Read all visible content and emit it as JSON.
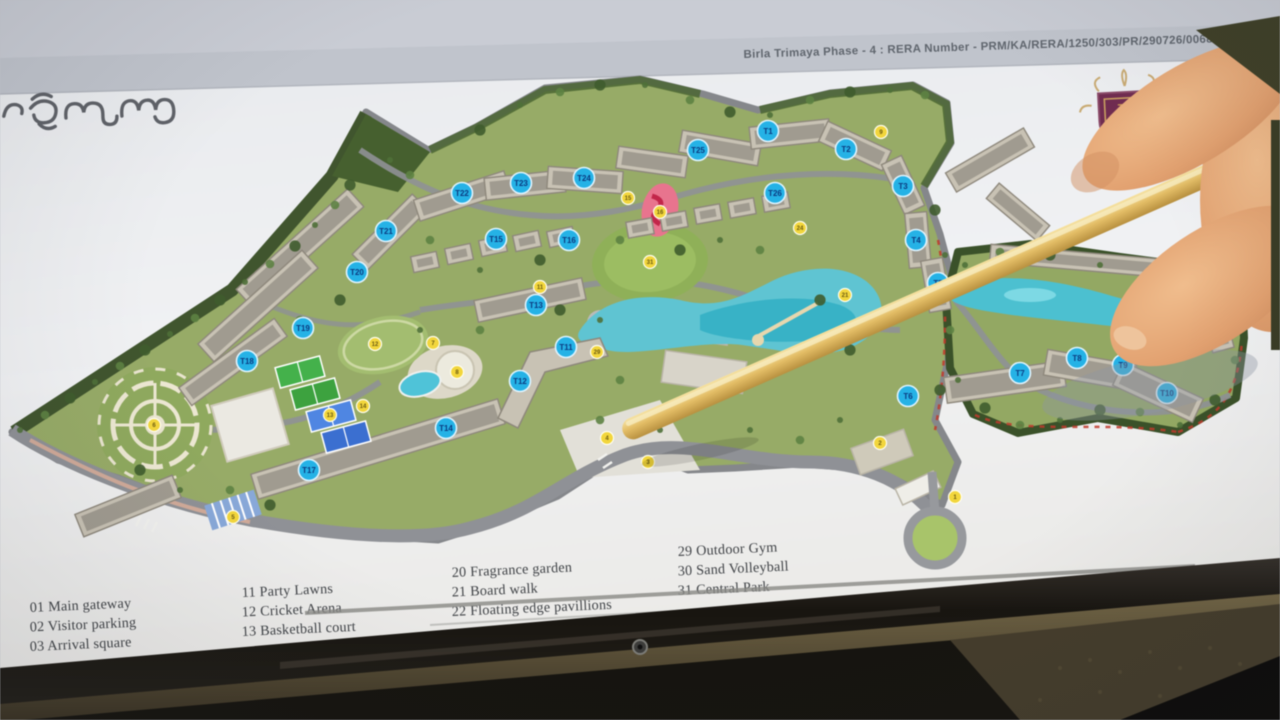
{
  "screen": {
    "header": {
      "rera_line": "Birla Trimaya Phase - 4 : RERA Number - PRM/KA/RERA/1250/303/PR/290726/006838"
    },
    "brand": {
      "kannada_title": "ತ್ರಿಮಾಯ",
      "logo_letter": "B"
    },
    "legend": {
      "columns": [
        {
          "items": [
            "01 Main gateway",
            "02 Visitor parking",
            "03 Arrival square"
          ]
        },
        {
          "items": [
            "11 Party Lawns",
            "12 Cricket Arena",
            "13 Basketball court"
          ]
        },
        {
          "items": [
            "20 Fragrance garden",
            "21 Board walk",
            "22 Floating edge pavillions"
          ]
        },
        {
          "items": [
            "29 Outdoor Gym",
            "30 Sand Volleyball",
            "31 Central Park"
          ]
        }
      ]
    },
    "map": {
      "towers": [
        {
          "label": "T1",
          "x": 768,
          "y": 131
        },
        {
          "label": "T2",
          "x": 846,
          "y": 149
        },
        {
          "label": "T3",
          "x": 903,
          "y": 186
        },
        {
          "label": "T4",
          "x": 916,
          "y": 240
        },
        {
          "label": "T5",
          "x": 938,
          "y": 283
        },
        {
          "label": "T6",
          "x": 908,
          "y": 396
        },
        {
          "label": "T7",
          "x": 1020,
          "y": 373
        },
        {
          "label": "T8",
          "x": 1077,
          "y": 358
        },
        {
          "label": "T9",
          "x": 1123,
          "y": 365
        },
        {
          "label": "T10",
          "x": 1167,
          "y": 393
        },
        {
          "label": "T11",
          "x": 566,
          "y": 347
        },
        {
          "label": "T12",
          "x": 520,
          "y": 381
        },
        {
          "label": "T13",
          "x": 536,
          "y": 305
        },
        {
          "label": "T14",
          "x": 446,
          "y": 428
        },
        {
          "label": "T15",
          "x": 496,
          "y": 239
        },
        {
          "label": "T16",
          "x": 569,
          "y": 240
        },
        {
          "label": "T17",
          "x": 309,
          "y": 470
        },
        {
          "label": "T18",
          "x": 247,
          "y": 361
        },
        {
          "label": "T19",
          "x": 303,
          "y": 328
        },
        {
          "label": "T20",
          "x": 357,
          "y": 272
        },
        {
          "label": "T21",
          "x": 386,
          "y": 231
        },
        {
          "label": "T22",
          "x": 462,
          "y": 193
        },
        {
          "label": "T23",
          "x": 521,
          "y": 183
        },
        {
          "label": "T24",
          "x": 584,
          "y": 178
        },
        {
          "label": "T25",
          "x": 698,
          "y": 150
        },
        {
          "label": "T26",
          "x": 775,
          "y": 193
        }
      ],
      "amenities": [
        {
          "label": "1",
          "x": 955,
          "y": 497
        },
        {
          "label": "2",
          "x": 880,
          "y": 443
        },
        {
          "label": "3",
          "x": 648,
          "y": 462
        },
        {
          "label": "4",
          "x": 607,
          "y": 438
        },
        {
          "label": "5",
          "x": 233,
          "y": 517
        },
        {
          "label": "6",
          "x": 154,
          "y": 425
        },
        {
          "label": "7",
          "x": 433,
          "y": 343
        },
        {
          "label": "8",
          "x": 457,
          "y": 372
        },
        {
          "label": "9",
          "x": 881,
          "y": 132
        },
        {
          "label": "11",
          "x": 540,
          "y": 287
        },
        {
          "label": "12",
          "x": 375,
          "y": 344
        },
        {
          "label": "13",
          "x": 330,
          "y": 415
        },
        {
          "label": "14",
          "x": 363,
          "y": 406
        },
        {
          "label": "15",
          "x": 628,
          "y": 198
        },
        {
          "label": "16",
          "x": 660,
          "y": 212
        },
        {
          "label": "20",
          "x": 733,
          "y": 388
        },
        {
          "label": "21",
          "x": 845,
          "y": 295
        },
        {
          "label": "24",
          "x": 800,
          "y": 228
        },
        {
          "label": "29",
          "x": 597,
          "y": 352
        },
        {
          "label": "31",
          "x": 650,
          "y": 262
        }
      ]
    },
    "colors": {
      "tower_marker": "#25b2e6",
      "amenity_marker": "#f2d63c",
      "water": "#55c2d2",
      "logo_maroon": "#702c50",
      "logo_gold": "#c89a58"
    }
  }
}
